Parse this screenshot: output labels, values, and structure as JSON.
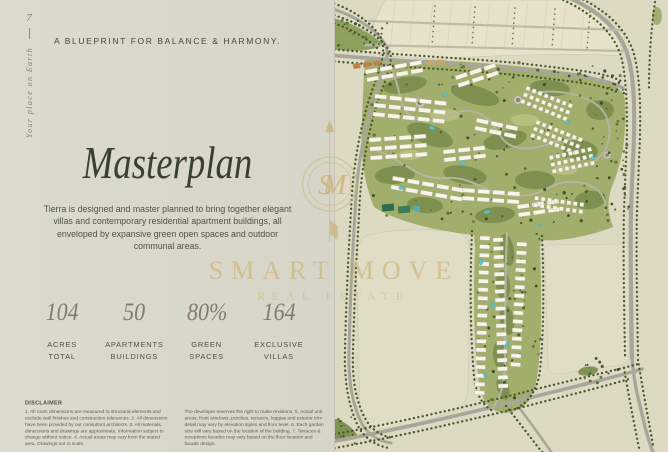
{
  "page": {
    "number": "7",
    "side_tagline": "Your place on Earth"
  },
  "header": {
    "kicker": "A BLUEPRINT FOR BALANCE & HARMONY.",
    "title": "Masterplan",
    "description": "Tierra is designed and master planned to bring together elegant villas and contemporary residential apartment buildings, all enveloped by expansive green open spaces and outdoor communal areas."
  },
  "stats": [
    {
      "value": "104",
      "label": "ACRES\nTOTAL"
    },
    {
      "value": "50",
      "label": "APARTMENTS\nBUILDINGS"
    },
    {
      "value": "80%",
      "label": "GREEN\nSPACES"
    },
    {
      "value": "164",
      "label": "EXCLUSIVE\nVILLAS"
    }
  ],
  "disclaimer": {
    "title": "DISCLAIMER",
    "col1": "1. All room dimensions are measured to structural elements and exclude wall finishes and construction tolerances. 2. All dimensions have been provided by our consultant architects. 3. All materials, dimensions and drawings are approximate. Information subject to change without notice. 4. Actual areas may vary from the stated area. Drawings not to scale.",
    "col2": "The developer reserves the right to make revisions. 5. Actual unit areas, front windows, porches, terraces, loggias and exterior trim detail may vary by elevation styles and floor level. 6. Each garden size will vary based on the location of the building. 7. Terraces & receptions facades may vary based on the floor location and facade design."
  },
  "watermark": {
    "monogram": "SM",
    "brand_line1": "SMART MOVE",
    "brand_line2": "REAL ESTATE"
  },
  "colors": {
    "panel_background": "#d9d8cb",
    "map_background": "#ddd9c3",
    "ink": "#3e4435",
    "stat_number": "#847a6a",
    "watermark_gold": "#d0bb8a",
    "map_green": "#a2ae6c",
    "map_road": "#a8a699",
    "tree_green": "#46562d",
    "pool_teal": "#5cc3ca"
  }
}
